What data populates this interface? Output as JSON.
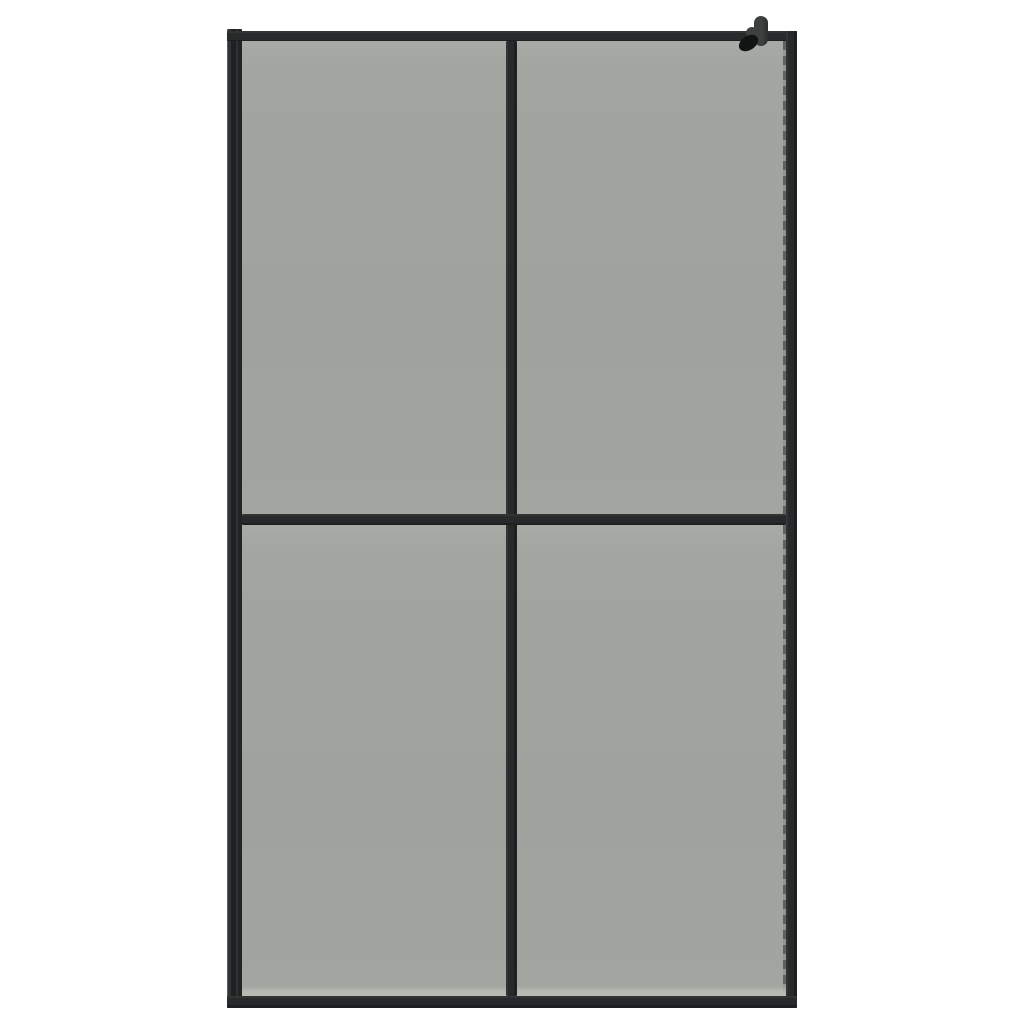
{
  "scene": {
    "description": "Product photo of a walk-in shower screen: black aluminium frame with dark smoked grey tinted glass divided into four panes (2 by 2), a thicker wall-mount profile on the left side, and a small black wall support bracket clamped over the top-right corner, on a plain white background",
    "object": "walk-in-shower-glass-screen",
    "background": "white studio backdrop"
  },
  "structure": {
    "pane_grid": "2x2",
    "panes": [
      "top-left",
      "top-right",
      "bottom-left",
      "bottom-right"
    ],
    "frame_parts": [
      "left-wall-profile",
      "top-bar",
      "right-bar",
      "bottom-bar",
      "center-vertical-bar",
      "center-horizontal-bar"
    ],
    "details": [
      "wall-bracket-top-right",
      "dashed-seal-right-edge",
      "light-reflection-bottom-glass-edge"
    ]
  },
  "colors": {
    "background": "#ffffff",
    "frame": "#27292a",
    "frame_highlight": "#3c3f3e",
    "glass": "#a2a5a0",
    "glass_edge_highlight": "#b7b9b3",
    "bracket": "#3c403f",
    "bracket_clamp": "#111413"
  }
}
